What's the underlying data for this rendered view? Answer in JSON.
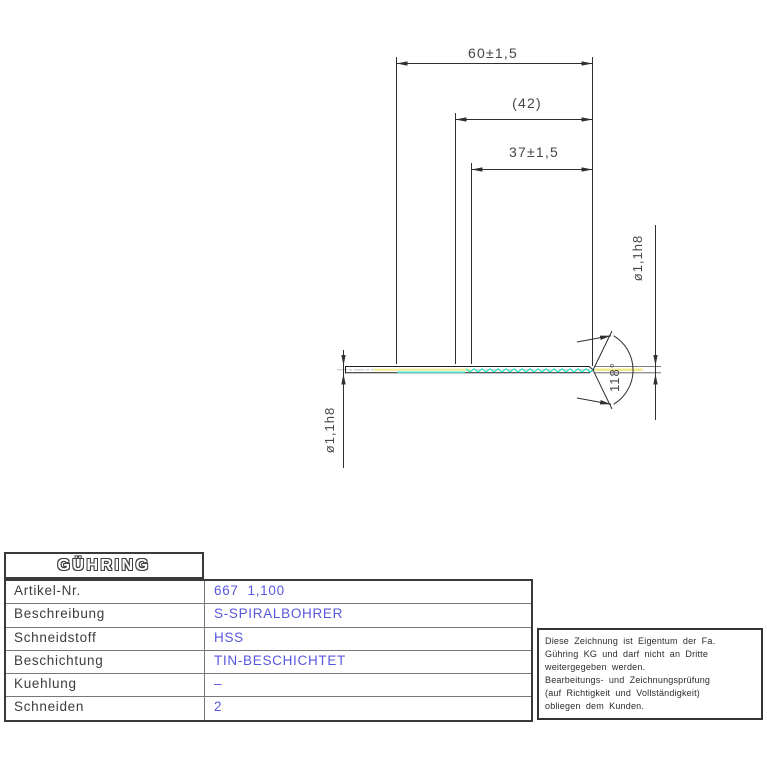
{
  "drawing": {
    "overall_length": "60±1,5",
    "reference_length": "(42)",
    "flute_length": "37±1,5",
    "diameter_left": "ø1,1h8",
    "diameter_right": "ø1,1h8",
    "point_angle": "118°"
  },
  "table": {
    "brand": "GÜHRING",
    "rows": [
      {
        "label": "Artikel-Nr.",
        "value": "667  1,100"
      },
      {
        "label": "Beschreibung",
        "value": "S-SPIRALBOHRER"
      },
      {
        "label": "Schneidstoff",
        "value": "HSS"
      },
      {
        "label": "Beschichtung",
        "value": "TIN-BESCHICHTET"
      },
      {
        "label": "Kuehlung",
        "value": "–"
      },
      {
        "label": "Schneiden",
        "value": "2"
      }
    ]
  },
  "disclaimer": {
    "lines": [
      "Diese Zeichnung ist Eigentum der Fa.",
      "Gühring KG und darf nicht an Dritte",
      "weitergegeben werden.",
      "Bearbeitungs- und Zeichnungsprüfung",
      "(auf Richtigkeit und Vollständigkeit)",
      "obliegen dem Kunden."
    ]
  },
  "colors": {
    "dimension_lines": "#2f2f2f",
    "value_text_blue": "#5757de",
    "flute_cyan": "#2de2c6",
    "margin_yellow": "#f3ec8e",
    "centerline_gray": "#c0c0c0"
  }
}
